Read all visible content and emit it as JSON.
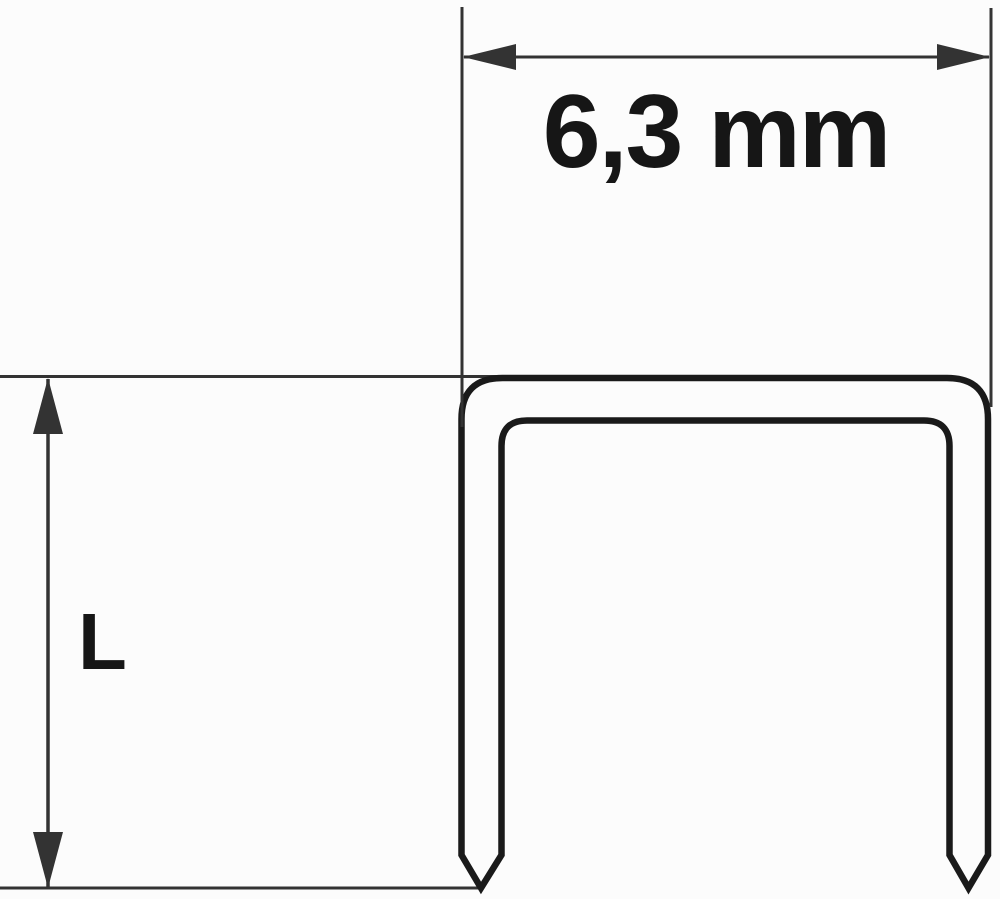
{
  "page": {
    "background_color": "#fcfcfc"
  },
  "diagram": {
    "kind": "staple-dimension-drawing",
    "colors": {
      "thin_line": "#333333",
      "outline": "#1a1a1a",
      "text": "#161616"
    },
    "width_dimension": {
      "label": "6,3 mm"
    },
    "length_dimension": {
      "label": "L"
    }
  }
}
